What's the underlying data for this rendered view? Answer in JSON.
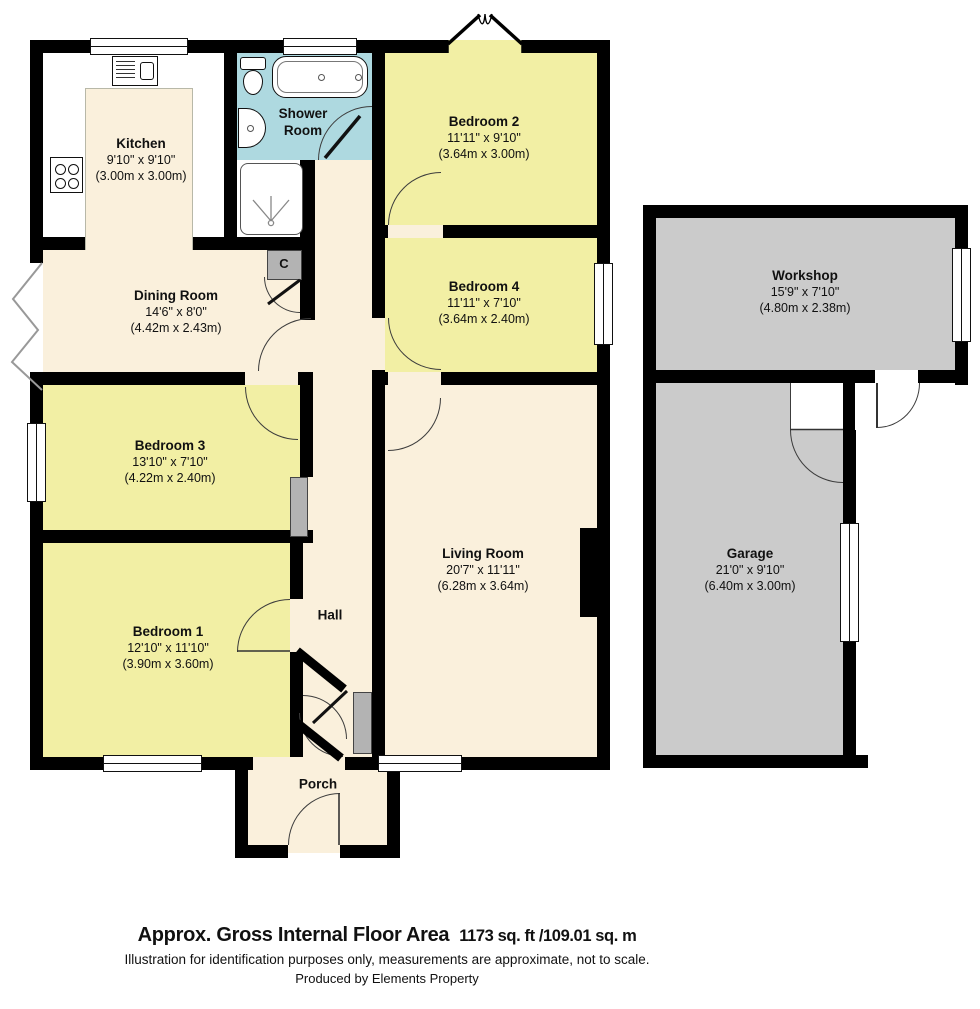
{
  "plan": {
    "rooms": [
      {
        "name": "Kitchen",
        "imperial": "9'10\" x 9'10\"",
        "metric": "(3.00m x 3.00m)"
      },
      {
        "name": "Shower Room",
        "imperial": "",
        "metric": ""
      },
      {
        "name": "Bedroom 2",
        "imperial": "11'11\" x 9'10\"",
        "metric": "(3.64m x 3.00m)"
      },
      {
        "name": "Bedroom 4",
        "imperial": "11'11\" x 7'10\"",
        "metric": "(3.64m x 2.40m)"
      },
      {
        "name": "Dining Room",
        "imperial": "14'6\" x 8'0\"",
        "metric": "(4.42m x 2.43m)"
      },
      {
        "name": "Workshop",
        "imperial": "15'9\" x 7'10\"",
        "metric": "(4.80m x 2.38m)"
      },
      {
        "name": "Bedroom 3",
        "imperial": "13'10\" x 7'10\"",
        "metric": "(4.22m x 2.40m)"
      },
      {
        "name": "Living Room",
        "imperial": "20'7\" x 11'11\"",
        "metric": "(6.28m x 3.64m)"
      },
      {
        "name": "Bedroom 1",
        "imperial": "12'10\" x 11'10\"",
        "metric": "(3.90m x 3.60m)"
      },
      {
        "name": "Garage",
        "imperial": "21'0\" x 9'10\"",
        "metric": "(6.40m x 3.00m)"
      }
    ],
    "labels": {
      "hall": "Hall",
      "porch": "Porch",
      "cupboard": "C"
    },
    "colors": {
      "bedroom_yellow": "#f2efa4",
      "cream": "#faf0dc",
      "shower_blue": "#aed9e0",
      "garage_gray": "#cbcbcb",
      "cupboard_gray": "#b3b3b3",
      "wall_black": "#000000"
    }
  },
  "footer": {
    "title": "Approx. Gross Internal Floor Area",
    "area_value": "1173 sq. ft /109.01 sq. m",
    "disclaimer": "Illustration for identification purposes only, measurements are approximate, not to scale.",
    "producer": "Produced by Elements Property"
  }
}
